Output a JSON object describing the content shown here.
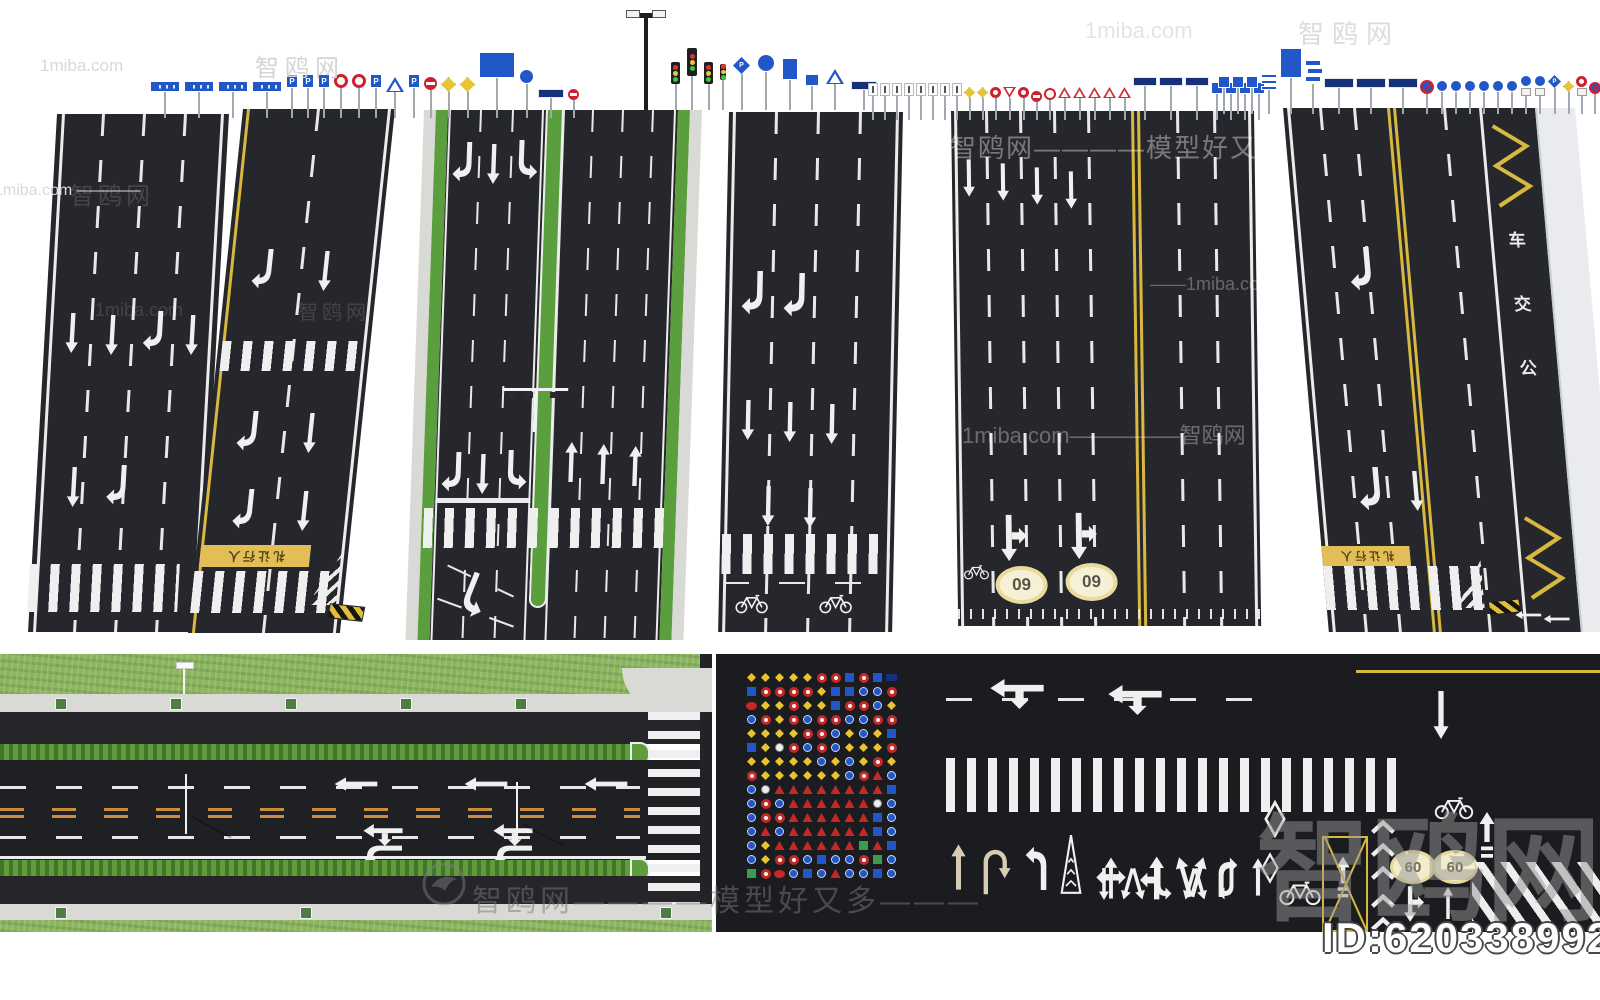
{
  "watermarks": {
    "wm1": "1miba.com",
    "wm2": "智鸥网",
    "wm3": "1miba.com ————",
    "wm4": "1miba.com",
    "wm5": "智鸥网",
    "wm6": "智鸥网————模型好又多",
    "wm7": "1miba.com—————智鸥网",
    "wm8": "——1miba.com",
    "wm9": "智鸥网————模型好又多———",
    "wm10": "智鸥网",
    "wm11": "智鸥网",
    "wm12": "1miba.com",
    "wm13": "智鸥网"
  },
  "id_badge": "ID:620338992",
  "labels": {
    "parking": "P",
    "speed09": "09",
    "speed60": "60",
    "yield_text": "礼让行人",
    "bus": [
      "车",
      "交",
      "公"
    ]
  },
  "sign_groups": {
    "left": [
      "dir-blue",
      "dir-blue",
      "dir-blue",
      "dir-blue",
      "p-sign",
      "p-sign",
      "p-sign",
      "ring-red",
      "ring-red",
      "p-sign",
      "tri-crossing",
      "p-sign",
      "no-entry",
      "warn-diamond",
      "warn-diamond",
      "board-blue-lg",
      "circle-blue",
      "dir-navy-sm",
      "no-entry-sm"
    ],
    "middle": [
      "street-lamp",
      "signal-3",
      "signal-tall",
      "signal-3",
      "signal-slim",
      "p-diamond",
      "circle-blue-lg",
      "board-blue-tall",
      "board-blue-sm",
      "tri-crossing",
      "dir-navy-sm"
    ],
    "right": [
      "lane-sign",
      "lane-sign",
      "lane-sign",
      "lane-sign",
      "lane-sign",
      "lane-sign",
      "lane-sign",
      "lane-sign",
      "warn-diamond-sm",
      "warn-diamond-sm",
      "ring-red-sm",
      "tri-yield",
      "ring-red-sm",
      "no-entry-sm",
      "ring-open",
      "tri-warn",
      "tri-warn",
      "tri-warn",
      "tri-warn",
      "tri-warn",
      "gantry-navy",
      "gantry-navy",
      "gantry-navy",
      "sq-blue",
      "sq-blue",
      "sq-blue",
      "sq-blue"
    ],
    "far_right": [
      "sq-blue",
      "sq-blue",
      "sq-blue",
      "stack-lines",
      "board-blue-portrait",
      "z-sign",
      "navy-wide",
      "navy-wide",
      "navy-wide",
      "slashes",
      "circle-blue-sm",
      "circle-blue-sm",
      "circle-blue-sm",
      "circle-blue-sm",
      "circle-blue-sm",
      "circle-blue-sm",
      "pair-bike",
      "pair-ped",
      "p-diamond-sm",
      "warn-diamond-sm",
      "red-pair",
      "no-park"
    ]
  },
  "sign_grid_rows": [
    "yyyyyrrBrBn",
    "BrrrryBBbbr",
    "eyyryyBrrby",
    "bryrbrrbbrr",
    "yyyyrrbybyB",
    "Bywrbrbyyyr",
    "yyyyybybyry",
    "ryyyyyybrtb",
    "bwttttttttB",
    "brbttttttwb",
    "brrttttttBb",
    "btbttttttBb",
    "byttttttgtB",
    "byrrbBbbrgb",
    "grebBbtbbBb"
  ],
  "road_markings": {
    "arrow_row": [
      "straight-tan",
      "uturn-tan",
      "turn",
      "cone",
      "cross",
      "tee",
      "fork",
      "turn-flip",
      "straight",
      "bike",
      "bars"
    ],
    "arrow_row2": [
      "straight-down",
      "fork-down",
      "turn-down",
      "fork-down",
      "turn-right-down"
    ]
  }
}
